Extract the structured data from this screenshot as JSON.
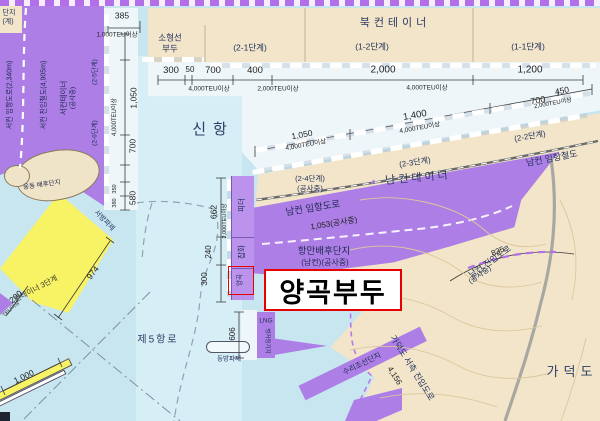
{
  "labels": {
    "corner": {
      "line1": "단지",
      "line2": "(계)"
    },
    "regions": {
      "shinhang": "신항",
      "bukcon": "북컨테이너",
      "namcon": "남컨테이너",
      "gadeokdo": "가덕도",
      "seocon": "서컨테이너",
      "seocon_status": "(공사중)",
      "ungdong": "웅동 배후단지",
      "feeder3": "컨테이너 3단계",
      "je5": "제5항로"
    },
    "stages": {
      "s11": "(1-1단계)",
      "s12": "(1-2단계)",
      "s21": "(2-1단계)",
      "s22": "(2-2단계)",
      "s23": "(2-3단계)",
      "s24": "(2-4단계)",
      "s24b": "(공사중)",
      "s25": "(2-5단계)",
      "s26": "(2-6단계)"
    },
    "piers": {
      "small1": "소형선",
      "small2": "부두",
      "feeder": "피더",
      "general": "잡화",
      "grain": "양곡",
      "grain_title": "양곡부두",
      "lng": "LNG",
      "lng2": "벙커링기지",
      "east_bw": "동방파제",
      "west_bw": "서방파제",
      "ship_repair": "수리조선단지"
    },
    "roads": {
      "namcon_rail": "남컨 임항철도",
      "namcon_road": "남컨 임항도로",
      "namcon_road_len": "1,053(공사중)",
      "hinterland1": "항만배후단지",
      "hinterland2": "(남컨)(공사중)",
      "access": "남컨 진입도로",
      "access_status": "(공사중)",
      "access_len": "835",
      "seocon_road": "서컨 임항도로(2,340m)",
      "seocon_rail": "서컨 진입철도(4,905m)",
      "gadeok_road": "가덕도 서측 진입도로",
      "gadeok_len": "4,156"
    },
    "dims": {
      "top": [
        "300",
        "50",
        "700",
        "400",
        "2,000",
        "1,200"
      ],
      "slant": [
        "1,050",
        "1,400",
        "700",
        "450"
      ],
      "west": [
        "385",
        "1,050",
        "700",
        "580"
      ],
      "west_small": [
        "350",
        "380"
      ],
      "east": [
        "662",
        "240",
        "300"
      ],
      "n606": "606",
      "n974": "974",
      "n200": "200",
      "n1000": "1,000"
    },
    "teu": {
      "t1000": "1,000TEU이상",
      "t2000": "2,000TEU이상",
      "t4000": "4,000TEU이상",
      "t_part": "TEU이상"
    }
  }
}
